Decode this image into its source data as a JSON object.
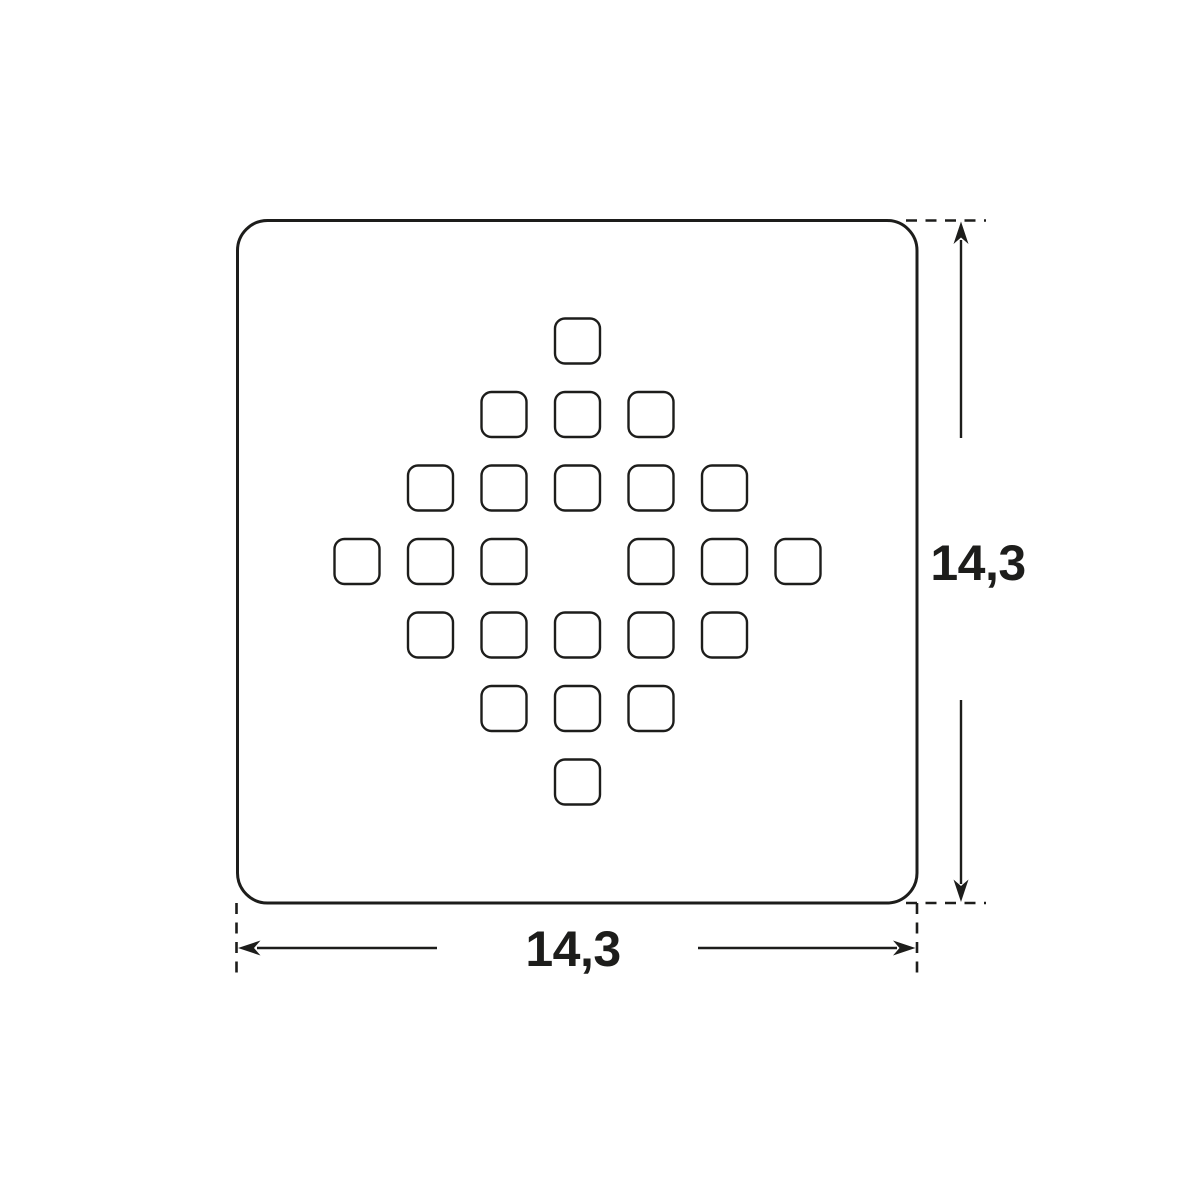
{
  "drawing": {
    "subject": "square shower drain grate - top view technical drawing",
    "background": "#ffffff",
    "line_color": "#1d1d1b",
    "plate": {
      "x": 237.5,
      "y": 220.5,
      "width": 679.5,
      "height": 682.5,
      "corner_radius": 30
    },
    "holes": {
      "count": 24,
      "center_x": 577.5,
      "center_y": 561.5,
      "spacing": 73.5,
      "size": 45,
      "corner_radius": 10,
      "offsets": [
        [
          0,
          -3
        ],
        [
          -1,
          -2
        ],
        [
          0,
          -2
        ],
        [
          1,
          -2
        ],
        [
          -2,
          -1
        ],
        [
          -1,
          -1
        ],
        [
          0,
          -1
        ],
        [
          1,
          -1
        ],
        [
          2,
          -1
        ],
        [
          -3,
          0
        ],
        [
          -2,
          0
        ],
        [
          -1,
          0
        ],
        [
          1,
          0
        ],
        [
          2,
          0
        ],
        [
          3,
          0
        ],
        [
          -2,
          1
        ],
        [
          -1,
          1
        ],
        [
          0,
          1
        ],
        [
          1,
          1
        ],
        [
          2,
          1
        ],
        [
          -1,
          2
        ],
        [
          0,
          2
        ],
        [
          1,
          2
        ],
        [
          0,
          3
        ]
      ]
    },
    "dimensions": {
      "height": {
        "label": "14,3"
      },
      "width": {
        "label": "14,3"
      }
    }
  }
}
